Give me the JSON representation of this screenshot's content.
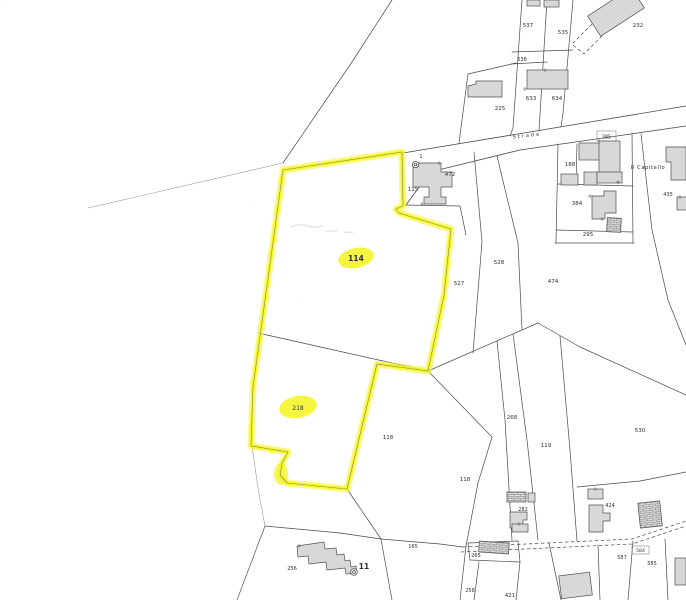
{
  "title": "cadastral-map-extract",
  "map": {
    "background": "#ffffff",
    "line_color": "#4a4a4a",
    "building_fill": "#d8d8d8",
    "highlight_color": "#f6f62c",
    "road": {
      "label": "Strada"
    },
    "locality": {
      "label": "Il Capitello"
    },
    "highlighted_parcel_ids": [
      "114",
      "218"
    ],
    "labels": [
      {
        "text": "114",
        "x": 356,
        "y": 261,
        "size": 7.5,
        "bold": true,
        "name": "parcel-label-114"
      },
      {
        "text": "218",
        "x": 298,
        "y": 410,
        "size": 6,
        "name": "parcel-label-218"
      },
      {
        "text": "115",
        "x": 413,
        "y": 191,
        "size": 5.5
      },
      {
        "text": "472",
        "x": 450,
        "y": 176,
        "size": 5.5
      },
      {
        "text": "1",
        "x": 421,
        "y": 158,
        "size": 5
      },
      {
        "text": "225",
        "x": 500,
        "y": 110,
        "size": 5.5
      },
      {
        "text": "633",
        "x": 531,
        "y": 100,
        "size": 5.5
      },
      {
        "text": "634",
        "x": 557,
        "y": 100,
        "size": 5.5
      },
      {
        "text": "538",
        "x": 522,
        "y": 61,
        "size": 5
      },
      {
        "text": "537",
        "x": 528,
        "y": 27,
        "size": 5.5
      },
      {
        "text": "535",
        "x": 563,
        "y": 34,
        "size": 5.5
      },
      {
        "text": "232",
        "x": 638,
        "y": 27,
        "size": 5.5
      },
      {
        "text": "385",
        "x": 606.5,
        "y": 138.5,
        "size": 4.8
      },
      {
        "text": "188",
        "x": 570,
        "y": 166,
        "size": 5.5
      },
      {
        "text": "384",
        "x": 577,
        "y": 205,
        "size": 5.5
      },
      {
        "text": "295",
        "x": 588,
        "y": 236,
        "size": 5.5
      },
      {
        "text": "435",
        "x": 668,
        "y": 196,
        "size": 5
      },
      {
        "text": "527",
        "x": 459,
        "y": 285,
        "size": 5.5
      },
      {
        "text": "528",
        "x": 499,
        "y": 264,
        "size": 5.5
      },
      {
        "text": "474",
        "x": 553,
        "y": 283,
        "size": 5.5
      },
      {
        "text": "118",
        "x": 388,
        "y": 439,
        "size": 5.5
      },
      {
        "text": "118",
        "x": 465,
        "y": 481,
        "size": 5.5
      },
      {
        "text": "268",
        "x": 512,
        "y": 419,
        "size": 5.5
      },
      {
        "text": "119",
        "x": 546,
        "y": 447,
        "size": 5.5
      },
      {
        "text": "530",
        "x": 640,
        "y": 432,
        "size": 5.5
      },
      {
        "text": "424",
        "x": 610,
        "y": 507,
        "size": 5
      },
      {
        "text": "282",
        "x": 523,
        "y": 511,
        "size": 5
      },
      {
        "text": "584",
        "x": 640.5,
        "y": 552,
        "size": 4.6
      },
      {
        "text": "587",
        "x": 622,
        "y": 559,
        "size": 5
      },
      {
        "text": "585",
        "x": 652,
        "y": 565,
        "size": 5
      },
      {
        "text": "265",
        "x": 476,
        "y": 557,
        "size": 5
      },
      {
        "text": "258",
        "x": 470,
        "y": 592,
        "size": 5
      },
      {
        "text": "421",
        "x": 510,
        "y": 597,
        "size": 5.5
      },
      {
        "text": "165",
        "x": 413,
        "y": 548,
        "size": 5
      },
      {
        "text": "256",
        "x": 292,
        "y": 570,
        "size": 5
      },
      {
        "text": "11",
        "x": 364,
        "y": 569,
        "size": 7.5,
        "bold": true,
        "name": "building-label-11"
      },
      {
        "text": "Strada",
        "x": 527,
        "y": 137,
        "size": 5,
        "rotate": -7,
        "spacing": 2,
        "name": "road-label"
      },
      {
        "text": "Il Capitello",
        "x": 648,
        "y": 169,
        "size": 5.2,
        "spacing": 0.6,
        "name": "locality-label"
      }
    ]
  }
}
